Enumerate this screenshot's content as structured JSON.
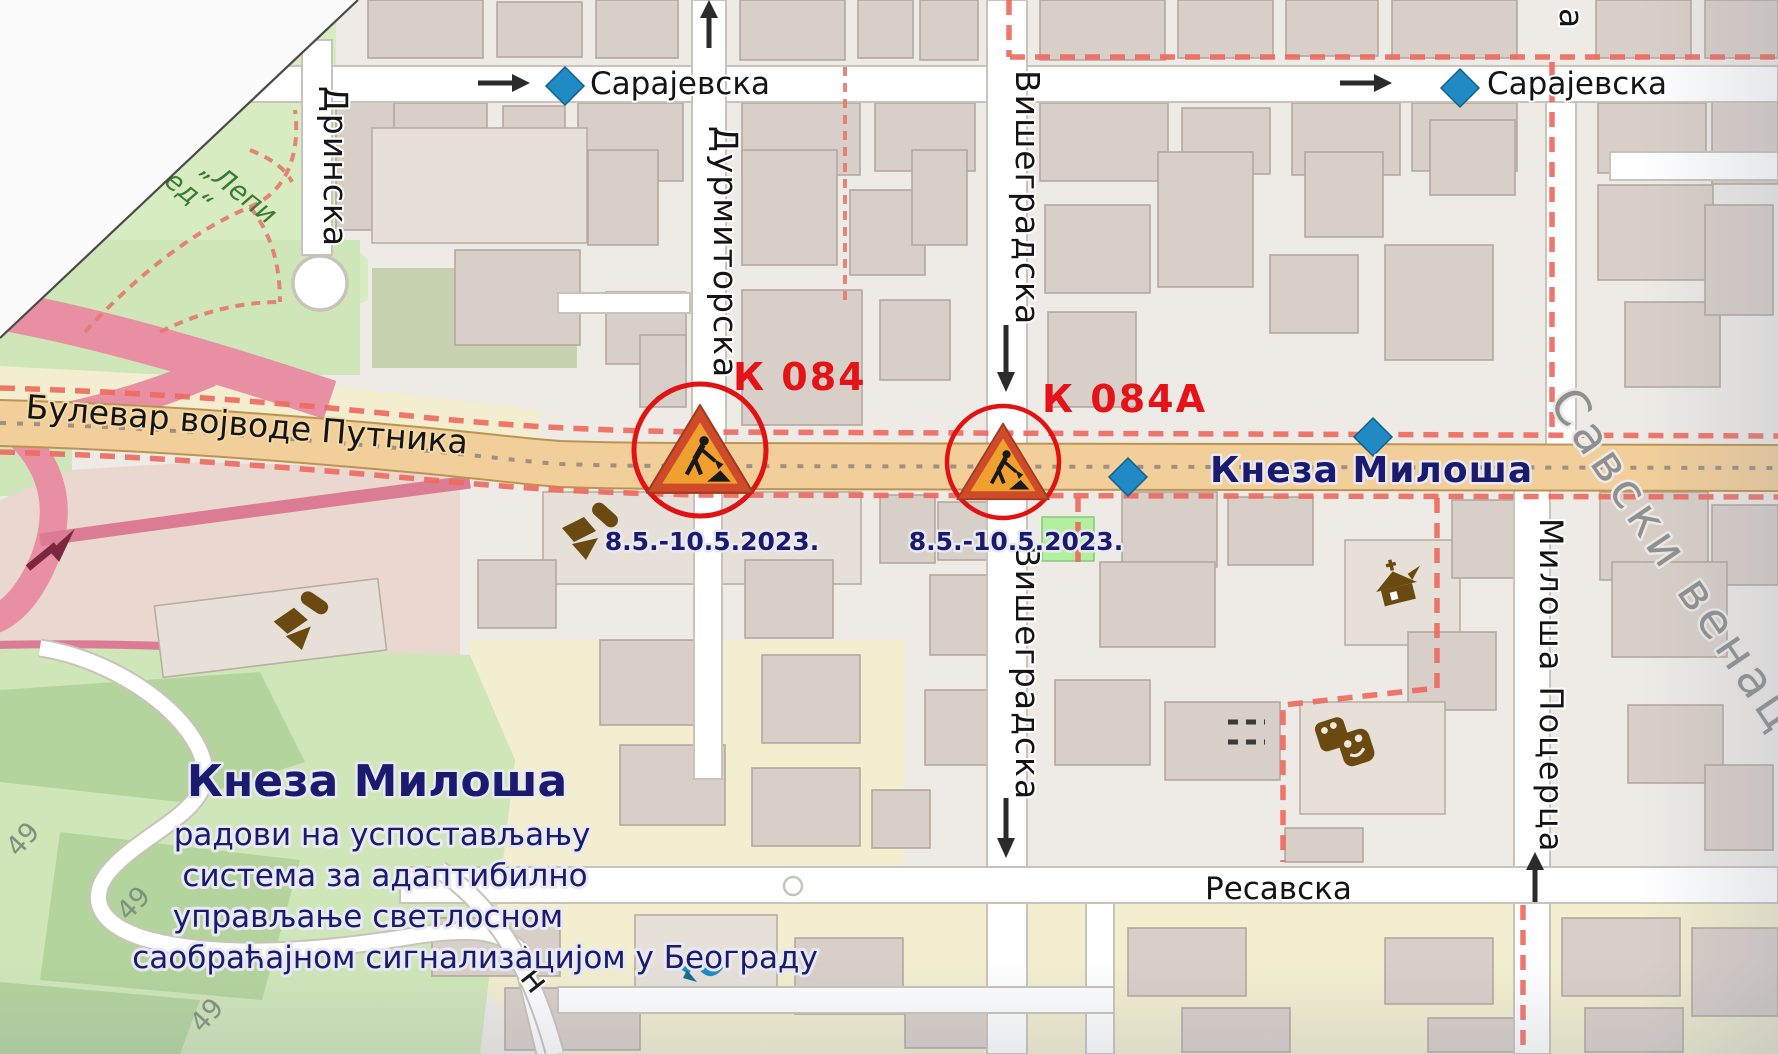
{
  "map": {
    "streets": {
      "sarajevska": "Сарајевска",
      "durmitorska": "Дурмиторска",
      "visegradska": "Вишеградска",
      "drinska": "Дринска",
      "bulevar_vojvode_putnika": "Булевар војводе Путника",
      "kneza_milosa_road": "Кнеза Милоша",
      "resavska": "Ресавска",
      "milosa_pocerca": "Милоша Поцерца",
      "un_partial": "Ун",
      "street_stub": "а"
    },
    "district": "Савски венац",
    "park_label": {
      "line1": "„Лепи",
      "line2": "ед“"
    },
    "trail_number": "49",
    "annotations": {
      "k084": {
        "label": "К 084",
        "date": "8.5.-10.5.2023."
      },
      "k084a": {
        "label": "К 084А",
        "date": "8.5.-10.5.2023."
      },
      "title": "Кнеза Милоша",
      "description_lines": [
        "радови на успостављању",
        "система за адаптибилно",
        "управљање светлосном",
        "саобраћајном сигнализацијом у Београду"
      ]
    },
    "colors": {
      "work_label_red": "#e51317",
      "annotation_navy": "#1a1a6e",
      "marker_blue": "#1f8ac4",
      "boundary_red": "#ee6a5e",
      "road_tan": "#f2cf9a",
      "historic_brown": "#6b4a12"
    }
  }
}
